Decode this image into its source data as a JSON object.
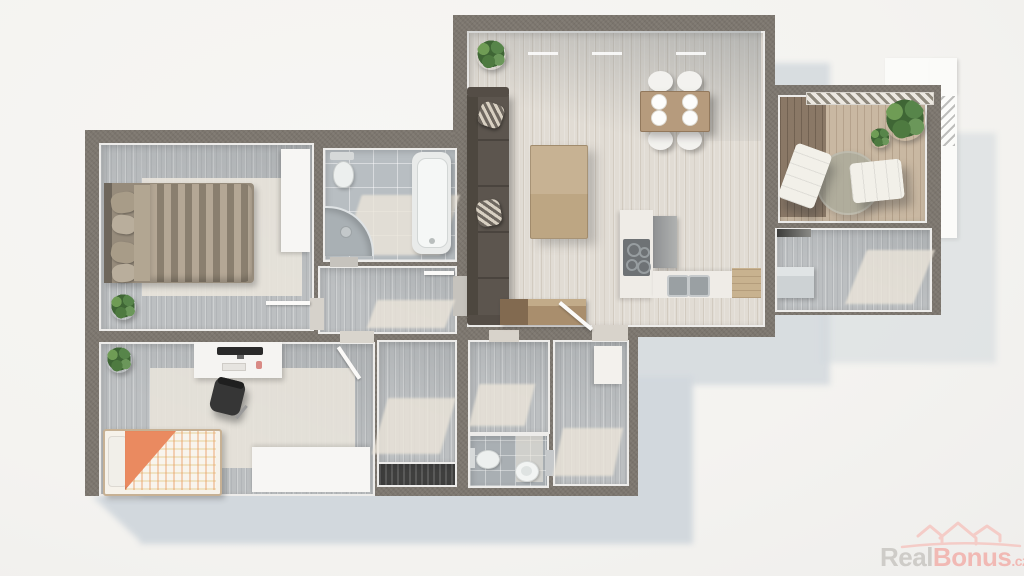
{
  "meta": {
    "image_type": "apartment-3d-floor-plan-top-down-render",
    "background": "#f5f4f1"
  },
  "watermark": {
    "brand_gray": "Real",
    "brand_accent": "Bonus",
    "tld": ".cz",
    "logo_icon": "three-house-roofs-with-swoosh",
    "color_gray": "#c9c6c2",
    "color_accent": "#f2b0ab"
  },
  "palette": {
    "wall": "#7c766e",
    "cast_shadow": "#d2d8dd",
    "floor_wood_gray": "#bcbfc1",
    "floor_wood_light": "#e1dcd4",
    "bathroom_tile": "#b8bec2",
    "terrace_deck_light": "#c9b8a2",
    "terrace_deck_dark": "#8a7866",
    "sofa_brown": "#5c554e",
    "dining_table_wood": "#b69b7d",
    "kitchen_counter": "#efece7",
    "bed_duvet_stripe_a": "#b4a795",
    "bed_duvet_stripe_b": "#8a7f6f",
    "single_bed_accent_orange": "#ea8a60",
    "room_trim_white": "#edecea"
  },
  "scene": {
    "rooms": [
      {
        "id": "bedroom-main",
        "label": "bedroom with double bed",
        "furniture": [
          "double-bed-striped-duvet",
          "four-pillows",
          "white-wardrobe",
          "light-rug",
          "potted-plant",
          "open-door"
        ]
      },
      {
        "id": "bathroom",
        "label": "bathroom",
        "furniture": [
          "bathtub",
          "corner-shower",
          "toilet"
        ]
      },
      {
        "id": "hallway-upper",
        "label": "hallway",
        "furniture": [
          "open-door"
        ]
      },
      {
        "id": "living-room-kitchen",
        "label": "living room with open kitchen",
        "furniture": [
          "corner-sofa",
          "two-striped-pillows",
          "coffee-table",
          "dining-table",
          "four-round-chairs",
          "four-plates",
          "kitchen-counter-L",
          "cooktop",
          "double-sink",
          "tall-cabinet",
          "wood-cabinet",
          "entry-bench",
          "potted-plant",
          "open-door"
        ]
      },
      {
        "id": "terrace",
        "label": "terrace with wooden deck",
        "furniture": [
          "lounge-chair-left",
          "lounge-chair-right",
          "round-rug",
          "large-plant",
          "railing"
        ]
      },
      {
        "id": "storage-right",
        "label": "storage room",
        "furniture": [
          "gray-box",
          "dark-doormat"
        ]
      },
      {
        "id": "bedroom-2",
        "label": "second bedroom / study",
        "furniture": [
          "single-bed-orange-duvet",
          "desk",
          "monitor",
          "office-chair",
          "white-wardrobe",
          "light-rug",
          "potted-plant",
          "open-door"
        ]
      },
      {
        "id": "closet",
        "label": "closet room",
        "furniture": []
      },
      {
        "id": "stair-shaft",
        "label": "dark shaft",
        "furniture": []
      },
      {
        "id": "pantry",
        "label": "pantry room",
        "furniture": []
      },
      {
        "id": "wc",
        "label": "separate WC",
        "furniture": [
          "toilet",
          "round-sink"
        ]
      },
      {
        "id": "corridor",
        "label": "corridor",
        "furniture": [
          "white-cabinet"
        ]
      }
    ]
  }
}
